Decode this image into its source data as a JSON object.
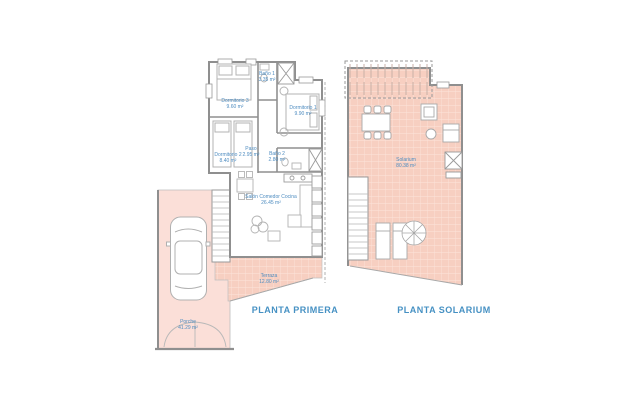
{
  "document": {
    "kind": "architectural floor plan, two levels"
  },
  "colors": {
    "background": "#ffffff",
    "tile_pink": "#f7cfc1",
    "tile_grid_line": "#fce4db",
    "porch_pink": "#fbdfd8",
    "wall_gray": "#8f8f8f",
    "furniture_gray": "#b3b3b3",
    "label_blue": "#4e8cc0",
    "title_blue": "#4691c3"
  },
  "plans": {
    "planta_primera": {
      "title": "PLANTA PRIMERA",
      "rooms": [
        {
          "name": "Dormitorio 3",
          "area": "9.60 m²"
        },
        {
          "name": "Baño 1",
          "area": "3.35 m²"
        },
        {
          "name": "Dormitorio 1",
          "area": "9.90 m²"
        },
        {
          "name": "Dormitorio 2",
          "area": "8.40 m²"
        },
        {
          "name": "Paso",
          "area": "2.95 m²"
        },
        {
          "name": "Baño 2",
          "area": "2.80 m²"
        },
        {
          "name": "Salón Comedor Cocina",
          "area": "26.45 m²"
        },
        {
          "name": "Terraza",
          "area": "12.80 m²"
        },
        {
          "name": "Porche",
          "area": "41.29 m²"
        }
      ]
    },
    "planta_solarium": {
      "title": "PLANTA SOLARIUM",
      "rooms": [
        {
          "name": "Solarium",
          "area": "80.38 m²"
        }
      ]
    }
  }
}
